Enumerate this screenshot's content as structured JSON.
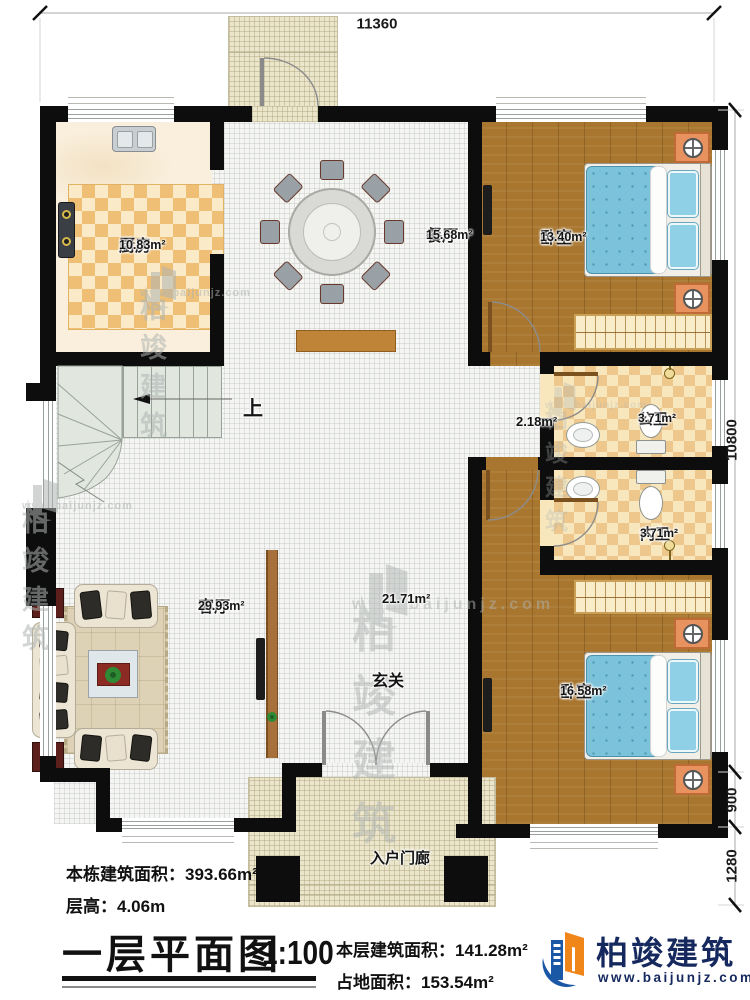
{
  "annotations": {
    "total_area": "本栋建筑面积：393.66m²",
    "floor_height": "层高：4.06m",
    "title": "一层平面图",
    "scale": "1:100",
    "floor_area": "本层建筑面积：141.28m²",
    "footprint_area": "占地面积：153.54m²"
  },
  "brand": {
    "name": "柏竣建筑",
    "site": "www.baijunjz.com"
  },
  "watermark": {
    "name": "柏竣建筑",
    "site": "www.baijunjz.com"
  },
  "dims": {
    "top": "11360",
    "right_main": "10800",
    "right_mid": "900",
    "right_bottom": "1280"
  },
  "rooms": {
    "kitchen": {
      "name": "厨房",
      "area": "10.83m²"
    },
    "dining": {
      "name": "餐厅",
      "area": "15.68m²"
    },
    "bedroom_top": {
      "name": "卧室",
      "area": "13.40m²"
    },
    "public_bath": {
      "name": "公卫",
      "area": "3.71m²"
    },
    "inner_bath": {
      "name": "内卫",
      "area": "3.71m²"
    },
    "living": {
      "name": "客厅",
      "area": "29.93m²"
    },
    "hall": {
      "name": "玄关",
      "area": "21.71m²"
    },
    "hall_sub_area": "2.18m²",
    "bedroom_bottom": {
      "name": "卧室",
      "area": "16.58m²"
    },
    "porch": {
      "name": "入户门廊"
    },
    "stairs": {
      "direction": "上"
    }
  },
  "colors": {
    "wall": "#0d0d0d",
    "wood_floor": "#a8762f",
    "bed_blue": "#7cc2da",
    "logo_blue": "#1a57a5",
    "logo_orange": "#f08519"
  }
}
